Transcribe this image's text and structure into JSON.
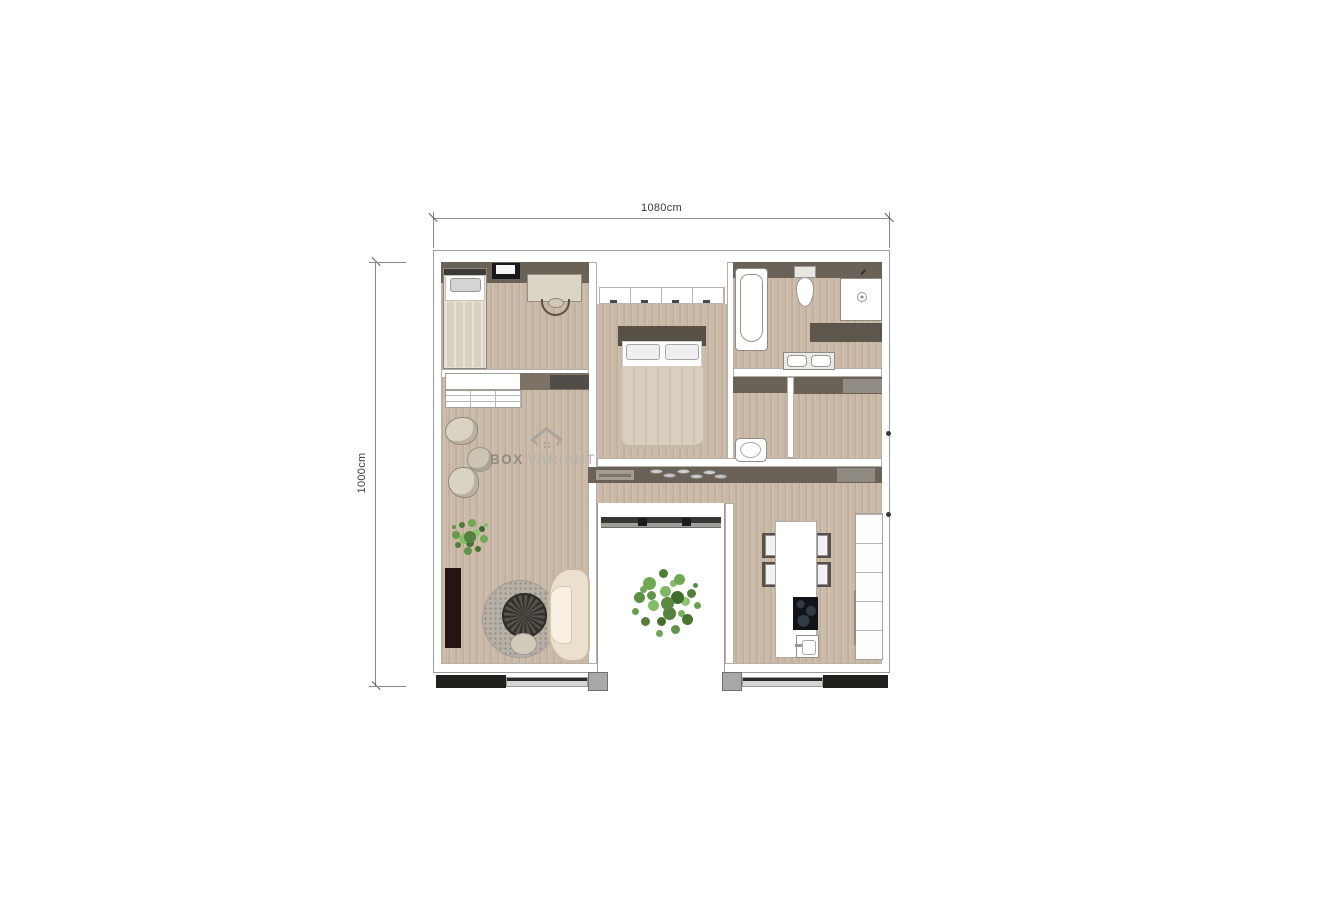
{
  "dimension_labels": {
    "top": "1080cm",
    "left": "1000cm"
  },
  "watermark": {
    "bold": "BOX",
    "light": "VARIANT"
  },
  "colors": {
    "floor": "#c9b9a6",
    "wall_outline": "#9a9a9a",
    "cabinet_band": "#6a6257",
    "door_panel": "#23211e",
    "door_rail": "#d6d6d6",
    "tree_green": "#5a8a42",
    "watermark_gray": "#9c9c94"
  },
  "icons": {
    "single-bed": "css-rect",
    "double-bed": "css-rect",
    "desk": "css-rect",
    "desk-chair": "css-arc",
    "tv": "css-rect",
    "wardrobe": "css-rect-row",
    "shelving-unit": "css-grid",
    "armchair": "css-circle",
    "round-side-table": "css-circle",
    "plant": "css-dot-cluster",
    "tv-cabinet": "css-rect",
    "round-rug": "css-circle",
    "coffee-table": "css-conic-circle",
    "sofa": "css-rounded-rect",
    "bathtub": "css-rounded-rect",
    "toilet": "css-ellipse",
    "shower": "css-square-drain",
    "vanity-counter": "css-rect",
    "double-washbasin": "css-rect-pair",
    "shoe-bench": "css-rect",
    "shoe": "css-ellipse",
    "doormat": "css-rect",
    "kitchen-island": "css-rect",
    "dining-chair": "css-square",
    "cooktop": "css-dark-rect",
    "kitchen-sink": "css-rect",
    "kitchen-cabinets": "css-rect-stack",
    "courtyard-tree": "css-dot-cluster",
    "sliding-door": "css-bar"
  }
}
